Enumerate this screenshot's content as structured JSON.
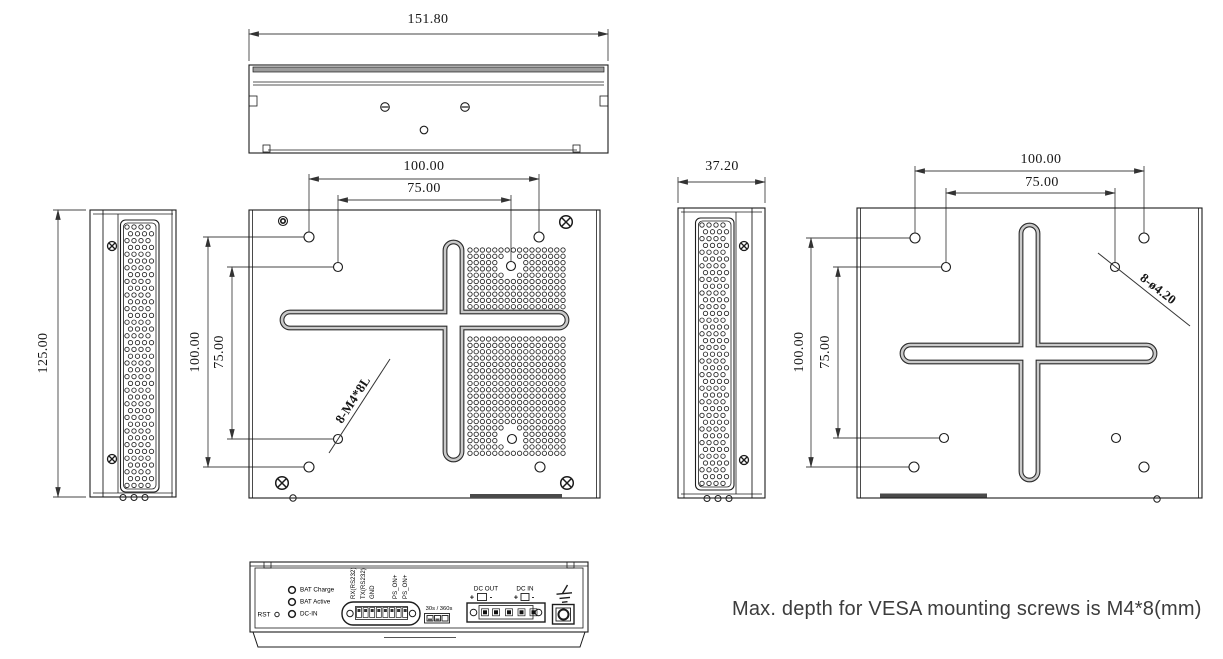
{
  "note": "Max. depth for VESA mounting screws is M4*8(mm)",
  "views": {
    "top": {
      "width": "151.80"
    },
    "left_side": {
      "height": "125.00"
    },
    "rear": {
      "width_100": "100.00",
      "width_75": "75.00",
      "height_100": "100.00",
      "height_75": "75.00",
      "thread_callout": "8-M4*8L"
    },
    "right_side": {
      "width": "37.20"
    },
    "vesa_plate": {
      "width_100": "100.00",
      "width_75": "75.00",
      "height_100": "100.00",
      "height_75": "75.00",
      "hole_callout": "8-ø4.20"
    },
    "bottom_panel": {
      "reset_label": "RST",
      "led_labels": [
        "BAT Charge",
        "BAT Active",
        "DC-IN"
      ],
      "terminal_labels": [
        "RX(RS232)",
        "TX(RS232)",
        "GND",
        "PS_ON+",
        "PS_ON+"
      ],
      "delay_switch_label": "30s / 360s",
      "dc_out_label": "DC OUT",
      "dc_in_label": "DC IN",
      "dc_out_plus": "+",
      "dc_out_minus": "-",
      "dc_in_plus": "+",
      "dc_in_minus": "-"
    }
  }
}
